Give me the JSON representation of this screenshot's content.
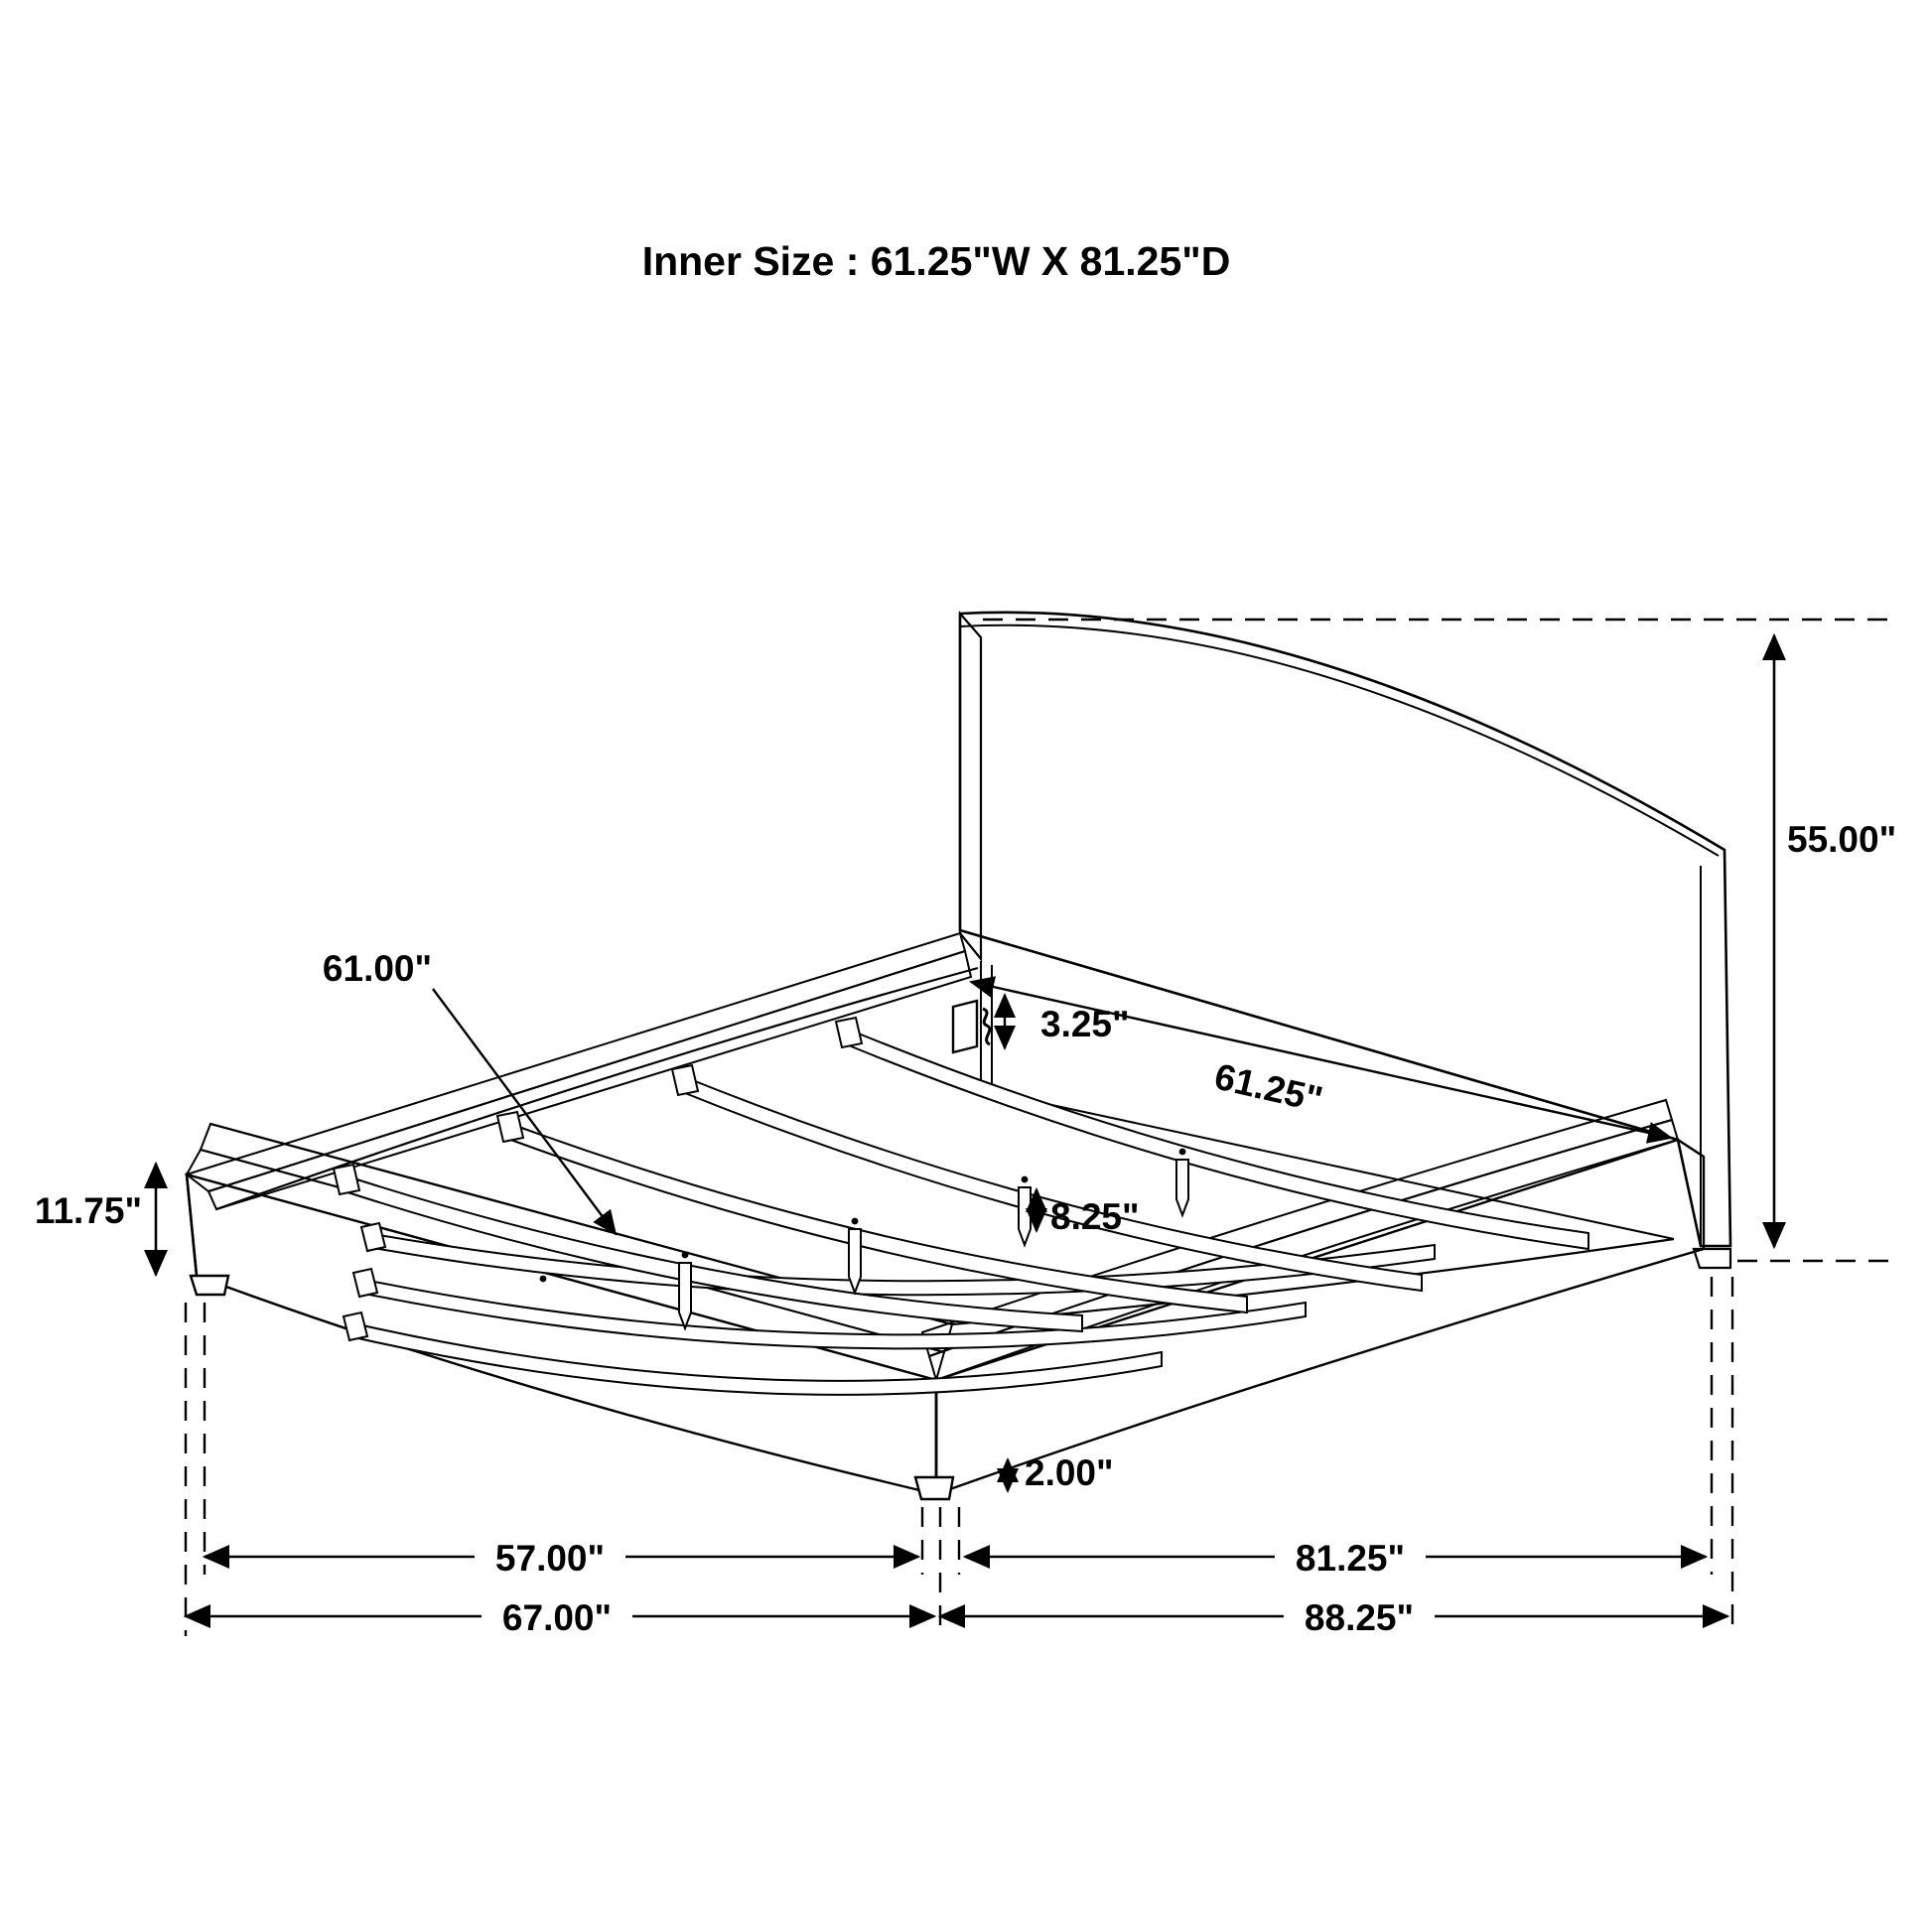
{
  "title": "Inner Size : 61.25\"W X 81.25\"D",
  "diagram": "platform-bed-dimension-drawing",
  "colors": {
    "ink": "#000000",
    "paper": "#ffffff"
  },
  "dimensions": {
    "slat_length": {
      "label": "61.00\""
    },
    "bracket_drop": {
      "label": "3.25\""
    },
    "inner_width": {
      "label": "61.25\""
    },
    "headboard_height": {
      "label": "55.00\""
    },
    "base_height": {
      "label": "11.75\""
    },
    "center_leg_height": {
      "label": "8.25\""
    },
    "foot_leg_height": {
      "label": "2.00\""
    },
    "inner_frame_width": {
      "label": "57.00\""
    },
    "overall_width": {
      "label": "67.00\""
    },
    "inner_frame_depth": {
      "label": "81.25\""
    },
    "overall_depth": {
      "label": "88.25\""
    }
  }
}
